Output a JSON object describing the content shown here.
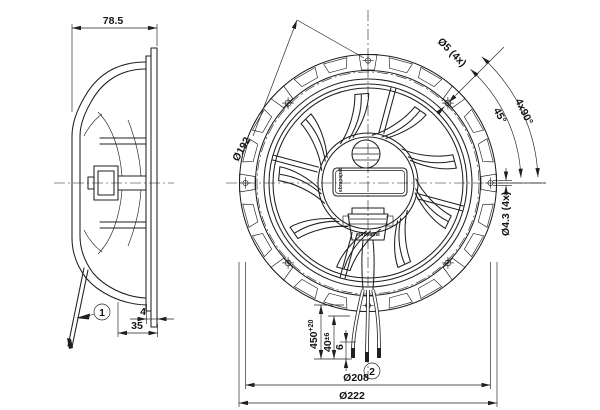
{
  "colors": {
    "background": "#ffffff",
    "line": "#1f1f1f"
  },
  "side_view": {
    "width_dim": "78.5",
    "flange_gap_dim": "4",
    "depth_dim": "35",
    "callout": "1"
  },
  "front_view": {
    "bolt_circle_dim": "Ø192",
    "corner_hole_dim": "Ø5 (4x)",
    "angle_spacing_dim": "4x90°",
    "angle_offset_dim": "45°",
    "side_hole_dim": "Ø4.3 (4x)",
    "brand_plate": "ebmpapst",
    "brand_gland": "ebmpapst",
    "cable_length_dim": {
      "value": "450",
      "tolerance": "+20"
    },
    "lead_length_dim": {
      "value": "40",
      "tolerance": "±6"
    },
    "strip_length_dim": "6",
    "callout": "2",
    "hole_pitch_dim": "Ø208",
    "outer_diameter_dim": "Ø222"
  }
}
